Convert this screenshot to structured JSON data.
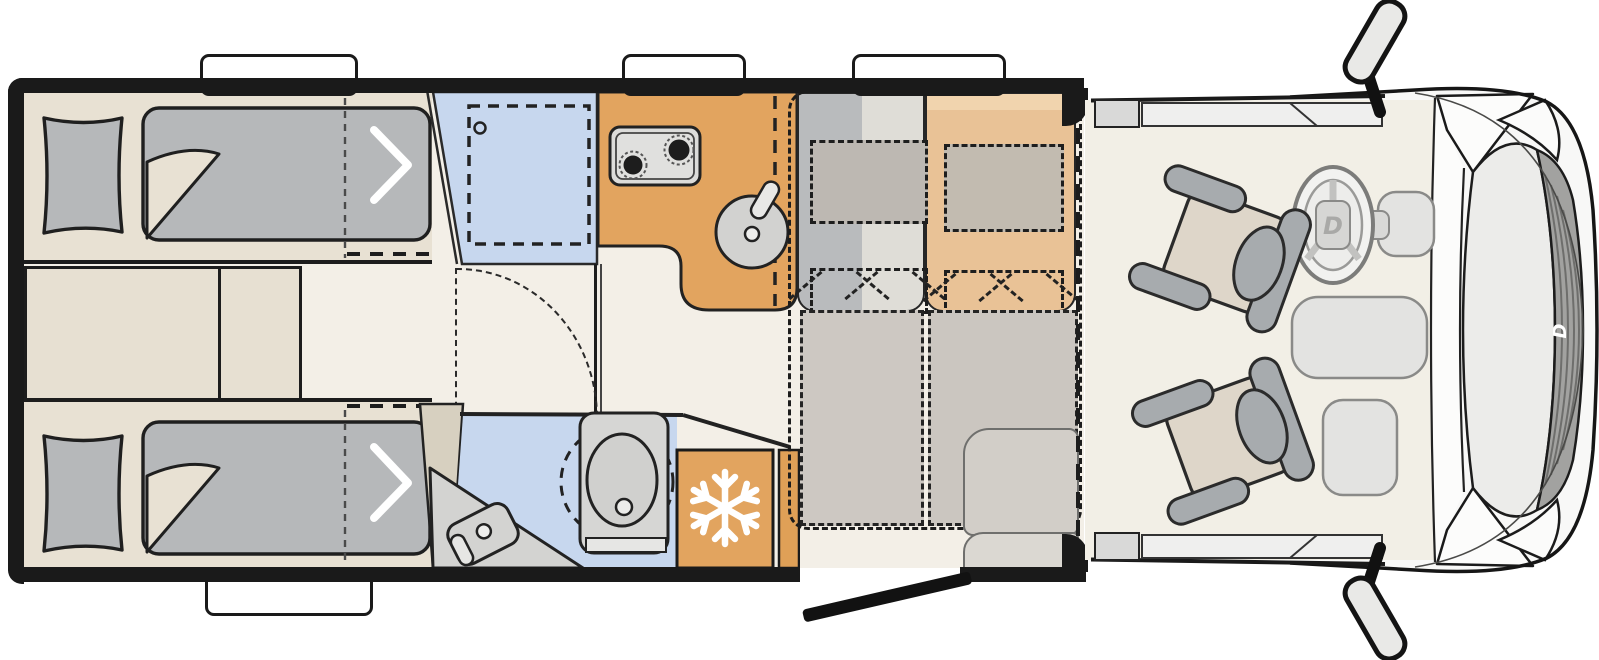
{
  "floorplan": {
    "view": "top-down",
    "vehicle": "motorhome floor plan",
    "front_direction": "right",
    "areas": [
      {
        "id": "bedroom",
        "label": "Rear bedroom with two single beds",
        "items": [
          "left single bed",
          "right single bed",
          "two pillows",
          "step cabinet between beds"
        ]
      },
      {
        "id": "shower",
        "label": "Shower cabin"
      },
      {
        "id": "washroom",
        "label": "Washroom with swivel toilet and corner washbasin"
      },
      {
        "id": "wardrobe",
        "label": "Wardrobe"
      },
      {
        "id": "kitchen",
        "label": "Kitchen block with two-burner hob and round sink"
      },
      {
        "id": "fridge",
        "label": "Refrigerator (snowflake symbol)"
      },
      {
        "id": "dinette",
        "label": "Dinette with two bench seats, bed conversion shown dashed"
      },
      {
        "id": "entrance",
        "label": "Entrance door shown open"
      },
      {
        "id": "cab",
        "label": "Driver cab with two swivelled captain seats, steering wheel and dashboard"
      }
    ],
    "counts": {
      "hob_burners": 2,
      "cab_seats": 2,
      "roof_windows_top": 3,
      "windows_bottom": 1,
      "single_beds": 2,
      "exterior_mirrors": 2
    }
  },
  "logo": {
    "brand_letter": "D"
  },
  "colors": {
    "wall": "#1a1a1a",
    "floor_cream": "#f3efe7",
    "furniture_beige": "#e8e1d3",
    "mattress_gray": "#b6b8ba",
    "wet_area_blue": "#c7d7ee",
    "kitchen_orange": "#e2a45f",
    "bench_tan": "#eac398",
    "bench_gray": "#b9bbbd",
    "cushion_gray": "#cdc8c2",
    "seat_beige": "#ded6c9",
    "seat_gray": "#a7abae",
    "white": "#ffffff",
    "body_light": "#f8f8f7",
    "grille_gray": "#a2a2a0"
  }
}
